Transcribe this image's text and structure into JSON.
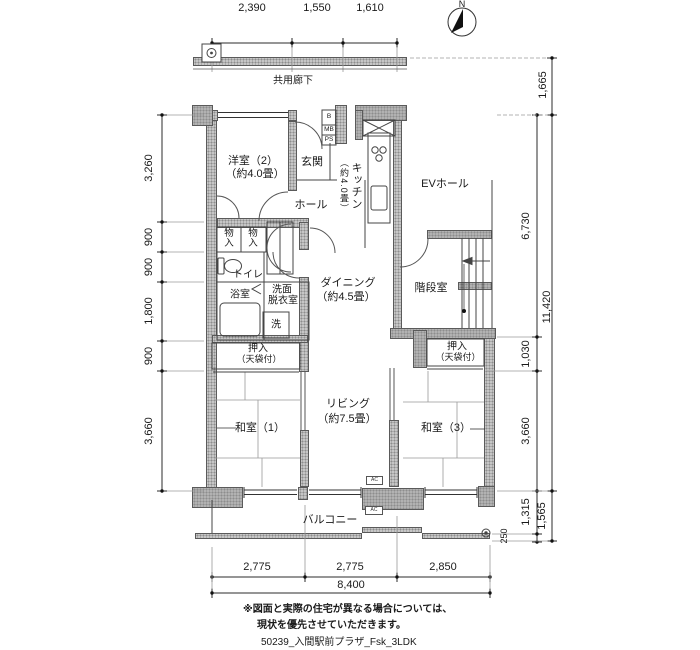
{
  "compass": {
    "north": "N"
  },
  "corridor": {
    "label": "共用廊下"
  },
  "dims": {
    "top": {
      "d1": "2,390",
      "d2": "1,550",
      "d3": "1,610"
    },
    "left": {
      "d1": "3,260",
      "d2": "900",
      "d3": "900",
      "d4": "1,800",
      "d5": "900",
      "d6": "3,660"
    },
    "right_inner": {
      "d1": "6,730",
      "d2": "1,030",
      "d3": "3,660",
      "d4": "1,315",
      "d5": "250"
    },
    "right_outer": {
      "d1": "1,665",
      "d2": "11,420",
      "d3": "1,565"
    },
    "bottom": {
      "d1": "2,775",
      "d2": "2,775",
      "d3": "2,850",
      "total": "8,400"
    }
  },
  "rooms": {
    "western2": {
      "name": "洋室（2）",
      "size": "（約4.0畳）"
    },
    "entrance": "玄関",
    "hall": "ホール",
    "kitchen": {
      "name": "キッチン",
      "size": "（約4.0畳）"
    },
    "ev_hall": "EVホール",
    "stairwell": "階段室",
    "dining": {
      "name": "ダイニング",
      "size": "（約4.5畳）"
    },
    "living": {
      "name": "リビング",
      "size": "（約7.5畳）"
    },
    "japanese1": "和室（1）",
    "japanese3": "和室（3）",
    "toilet": "トイレ",
    "bath": "浴室",
    "washroom": {
      "line1": "洗面",
      "line2": "脱衣室"
    },
    "washer": "洗",
    "storage": "物入",
    "closet": {
      "name": "押入",
      "note": "（天袋付）"
    },
    "balcony": "バルコニー"
  },
  "labels": {
    "b": "B",
    "mb": "MB",
    "ps": "PS",
    "ac": "AC"
  },
  "notes": {
    "line1": "※図面と実際の住宅が異なる場合については、",
    "line2": "現状を優先させていただきます。",
    "code": "50239_入間駅前プラザ_Fsk_3LDK"
  }
}
